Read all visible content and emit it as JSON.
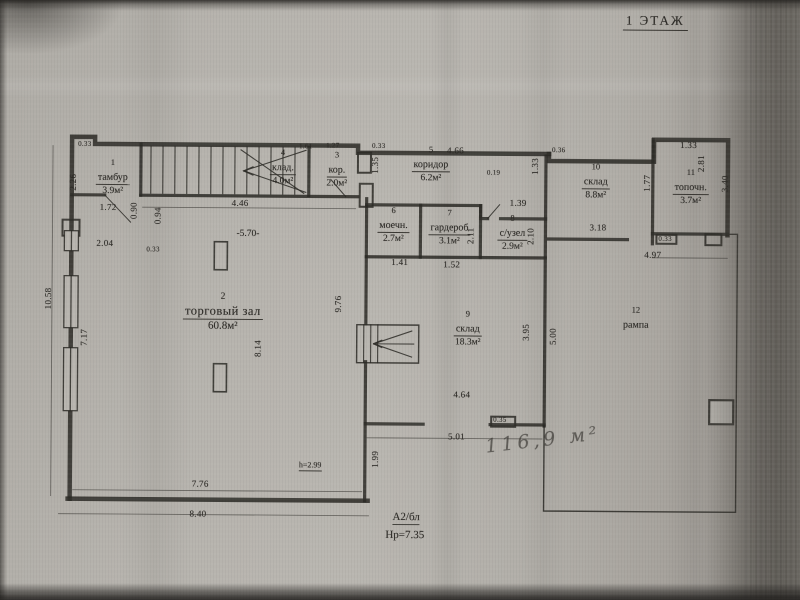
{
  "title": "1 ЭТАЖ",
  "rooms": [
    {
      "num": "1",
      "name": "тамбур",
      "area": "3.9м²"
    },
    {
      "num": "2",
      "name": "торговый зал",
      "area": "60.8м²"
    },
    {
      "num": "3",
      "name": "кор.",
      "area": "2.0м²"
    },
    {
      "num": "4",
      "name": "клад.",
      "area": "4.0м²"
    },
    {
      "num": "5",
      "name": "коридор",
      "area": "6.2м²"
    },
    {
      "num": "6",
      "name": "моечн.",
      "area": "2.7м²"
    },
    {
      "num": "7",
      "name": "гардероб",
      "area": "3.1м²"
    },
    {
      "num": "8",
      "name": "с/узел",
      "area": "2.9м²"
    },
    {
      "num": "9",
      "name": "склад",
      "area": "18.3м²"
    },
    {
      "num": "10",
      "name": "склад",
      "area": "8.8м²"
    },
    {
      "num": "11",
      "name": "топочн.",
      "area": "3.7м²"
    },
    {
      "num": "12",
      "name": "рампа",
      "area": ""
    }
  ],
  "dims": {
    "d033_a": "0.33",
    "d172": "1.72",
    "d204": "2.04",
    "d033_b": "0.33",
    "d446": "4.46",
    "d161": "1.61",
    "d127": "1.27",
    "d033_c": "0.33",
    "d466": "4.66",
    "d019": "0.19",
    "d139": "1.39",
    "d036": "0.36",
    "d133_a": "1.33",
    "d318": "3.18",
    "d497": "4.97",
    "d033_d": "0.33",
    "d141": "1.41",
    "d152": "1.52",
    "d464": "4.64",
    "d501": "5.01",
    "d035": "0.35",
    "d776": "7.76",
    "d840": "8.40",
    "d226": "2.26",
    "d090": "0.90",
    "d094": "0.94",
    "d135": "1.35",
    "d1058": "10.58",
    "d717": "7.17",
    "d976": "9.76",
    "d814": "8.14",
    "d211": "2.11",
    "d210": "2.10",
    "d133_b": "1.33",
    "d177": "1.77",
    "d281": "2.81",
    "d340": "3.40",
    "d395": "3.95",
    "d500": "5.00",
    "d199": "1.99"
  },
  "annotations": {
    "elevation": "-5.70-",
    "ceiling_height": "h=2.99",
    "section_label": "А2/бл",
    "section_height": "Нр=7.35",
    "handwritten_area": "116,9 м²"
  },
  "colors": {
    "ink": "#2c2a26",
    "paper": "#b3b0aa"
  }
}
